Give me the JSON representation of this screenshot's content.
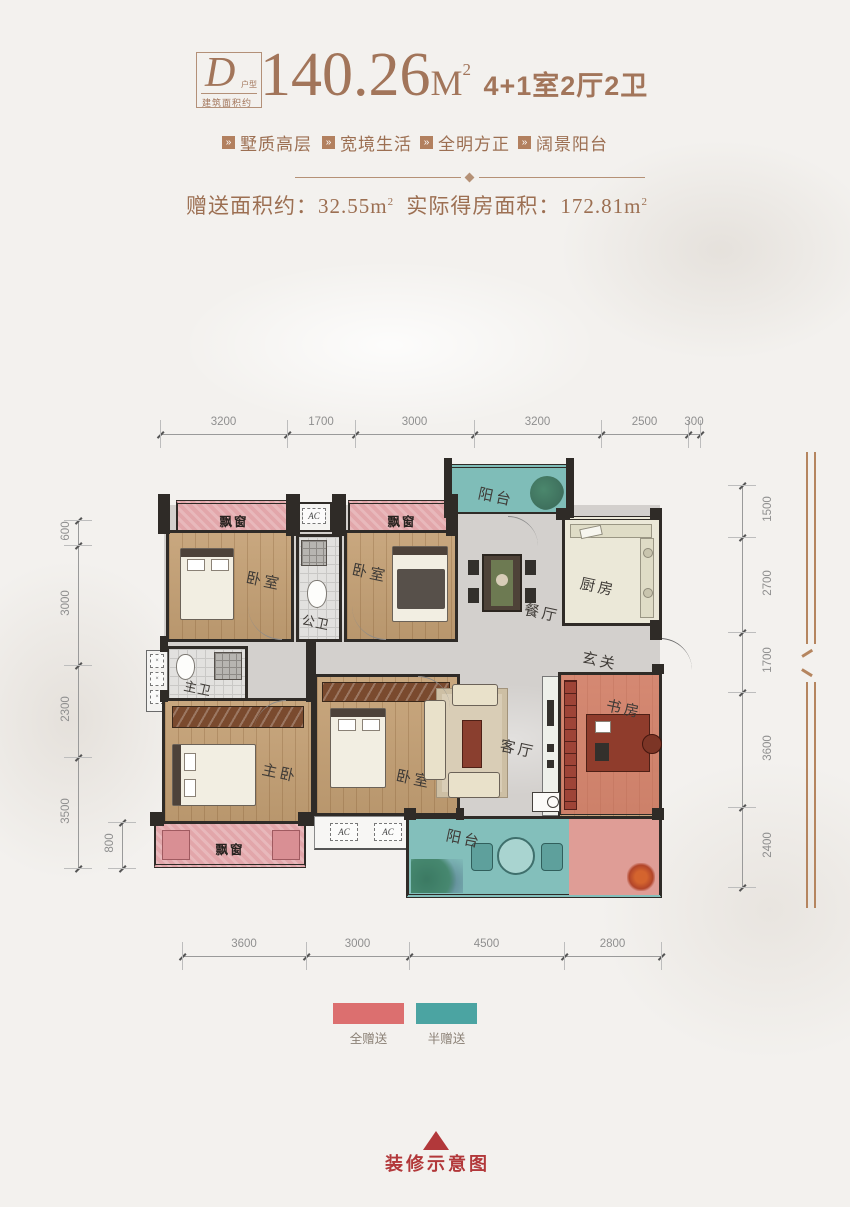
{
  "colors": {
    "accent": "#a2755a",
    "wall": "#2f2b27",
    "dim_text": "#8f8f8f",
    "footer_red": "#b2383a",
    "bay_pink": "#e2a6aa",
    "balcony_teal": "#7fbdb8",
    "bonus_pink": "#dc6f6f",
    "bonus_teal": "#4ba4a2"
  },
  "header": {
    "badge": {
      "letter": "D",
      "suffix": "户型",
      "caption": "建筑面积约"
    },
    "area_number": "140.26",
    "area_unit": "M",
    "area_sup": "2",
    "layout_text": "4+1室2厅2卫",
    "features": [
      {
        "label": "墅质高层"
      },
      {
        "label": "宽境生活"
      },
      {
        "label": "全明方正"
      },
      {
        "label": "阔景阳台"
      }
    ],
    "bonus": {
      "label1": "赠送面积约：",
      "value1": "32.55m",
      "sup1": "2",
      "label2": "实际得房面积：",
      "value2": "172.81m",
      "sup2": "2"
    }
  },
  "plan": {
    "rooms": {
      "bay_top_left": "飘窗",
      "bedroom_top_left": "卧室",
      "bath_public": "公卫",
      "bay_top_right": "飘窗",
      "bedroom_top_right": "卧室",
      "balcony_top": "阳台",
      "kitchen": "厨房",
      "dining": "餐厅",
      "hall": "玄关",
      "bath_master": "主卫",
      "master": "主卧",
      "bay_bottom": "飘窗",
      "bedroom_bottom": "卧室",
      "living": "客厅",
      "study": "书房",
      "balcony_bottom": "阳台",
      "ac_mark": "AC"
    },
    "dims": {
      "top": [
        "3200",
        "1700",
        "3000",
        "3200",
        "2500",
        "300"
      ],
      "bottom": [
        "3600",
        "3000",
        "4500",
        "2800"
      ],
      "left": [
        "600",
        "3000",
        "2300",
        "3500"
      ],
      "left_inner": [
        "800"
      ],
      "right": [
        "1500",
        "2700",
        "1700",
        "3600",
        "2400"
      ]
    }
  },
  "legend": {
    "items": [
      {
        "label": "全赠送",
        "color": "#dc6f6f"
      },
      {
        "label": "半赠送",
        "color": "#4ba4a2"
      }
    ]
  },
  "footer": {
    "caption": "装修示意图"
  }
}
